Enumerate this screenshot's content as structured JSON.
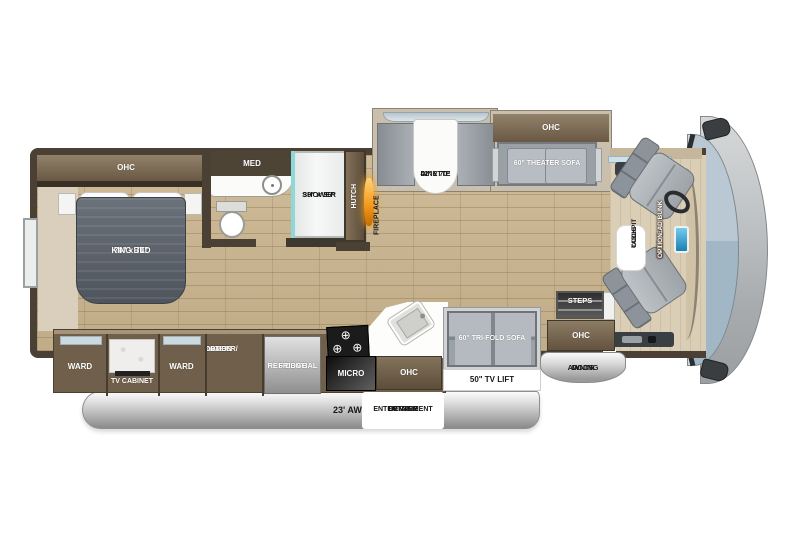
{
  "title": "Class A motorhome floor plan",
  "bedroom": {
    "ohc": "OHC",
    "bed_size": "70\" x 74\"",
    "bed_name": "KING BED"
  },
  "bathroom": {
    "med": "MED",
    "shower_size": "30\" x 36\"",
    "shower_name": "SHOWER"
  },
  "galley": {
    "hutch": "HUTCH",
    "fireplace": "FIREPLACE",
    "ward_left": "WARD",
    "tv_cabinet": "TV CABINET",
    "ward_right": "WARD",
    "washer_dryer_1": "WASHER/",
    "washer_dryer_2": "DRYER",
    "washer_dryer_3": "COMBO",
    "washer_dryer_4": "OPTION",
    "fridge_1": "RESIDENTIAL",
    "fridge_2": "FRIDGE",
    "micro": "MICRO",
    "ohc": "OHC"
  },
  "dinette": {
    "size": "42\" x 70\"",
    "name": "DINETTE"
  },
  "living": {
    "ohc": "OHC",
    "theater_sofa": "60\" THEATER SOFA",
    "tri_fold_sofa": "60\" TRI-FOLD SOFA",
    "tv_lift": "50\" TV LIFT"
  },
  "entry": {
    "steps": "STEPS",
    "ohc": "OHC",
    "door_awning_1": "DOOR",
    "door_awning_2": "AWNING"
  },
  "cockpit": {
    "table_1": "COCKPIT",
    "table_2": "TABLE",
    "bunk_1": "DROP-DOWN",
    "bunk_2": "OVERHEAD BUNK",
    "bunk_3": "OPTION"
  },
  "exterior": {
    "awning": "23' AWNING",
    "oec_1": "OUTSIDE",
    "oec_2": "ENTERTAINMENT",
    "oec_3": "CENTER"
  },
  "icons": {
    "burner": "⊕"
  },
  "colors": {
    "floor_wood": "#c9b593",
    "wall": "#4a4134",
    "cabinet": "#70604b",
    "bed": "#565c64",
    "sofa": "#99a0a6",
    "fireplace_glow": "#f59a1e",
    "windshield": "#aec2cf",
    "awning_silver": "#bdbdbd"
  }
}
